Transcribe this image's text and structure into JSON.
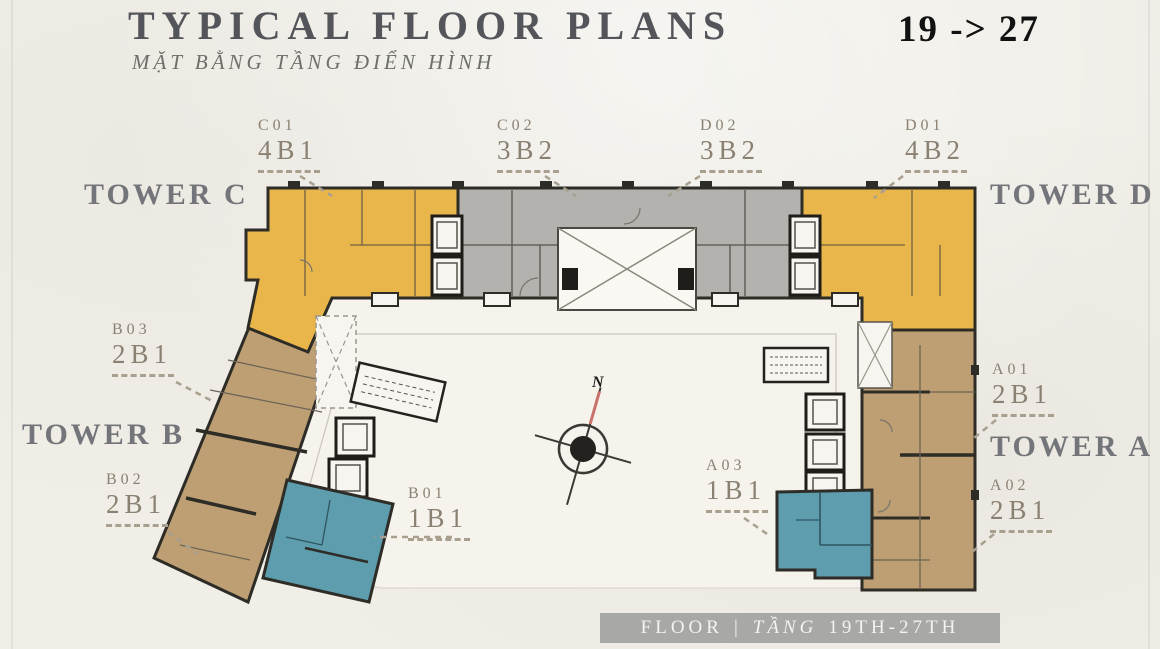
{
  "header": {
    "title": "TYPICAL FLOOR PLANS",
    "subtitle": "MẶT BẰNG TẦNG ĐIỂN HÌNH",
    "floor_range": "19 -> 27"
  },
  "towers": [
    {
      "label": "TOWER C"
    },
    {
      "label": "TOWER D"
    },
    {
      "label": "TOWER B"
    },
    {
      "label": "TOWER A"
    }
  ],
  "units": [
    {
      "code": "C01",
      "type": "4B1"
    },
    {
      "code": "C02",
      "type": "3B2"
    },
    {
      "code": "D02",
      "type": "3B2"
    },
    {
      "code": "D01",
      "type": "4B2"
    },
    {
      "code": "B03",
      "type": "2B1"
    },
    {
      "code": "B02",
      "type": "2B1"
    },
    {
      "code": "B01",
      "type": "1B1"
    },
    {
      "code": "A01",
      "type": "2B1"
    },
    {
      "code": "A02",
      "type": "2B1"
    },
    {
      "code": "A03",
      "type": "1B1"
    }
  ],
  "compass": {
    "north_label": "N"
  },
  "footer": {
    "floor_en": "FLOOR",
    "divider": "|",
    "floor_vi": "TẦNG",
    "range": "19TH-27TH"
  },
  "colors": {
    "background": "#f0eee7",
    "tower_cd_yellow": "#e9b64c",
    "center_gray": "#b4b2af",
    "tower_ab_brown": "#bd9f73",
    "unit_teal": "#5d9dae",
    "wall_dark": "#2e2c26",
    "label_text": "#8b8173",
    "tower_text": "#74757a",
    "title_text": "#54555a",
    "subtitle_text": "#6e6f6b",
    "range_text": "#111111",
    "footer_bg": "#a8a8a5",
    "footer_text": "#f4f3ef",
    "compass_red": "#c9726c",
    "courtyard": "#f5f3ec"
  }
}
